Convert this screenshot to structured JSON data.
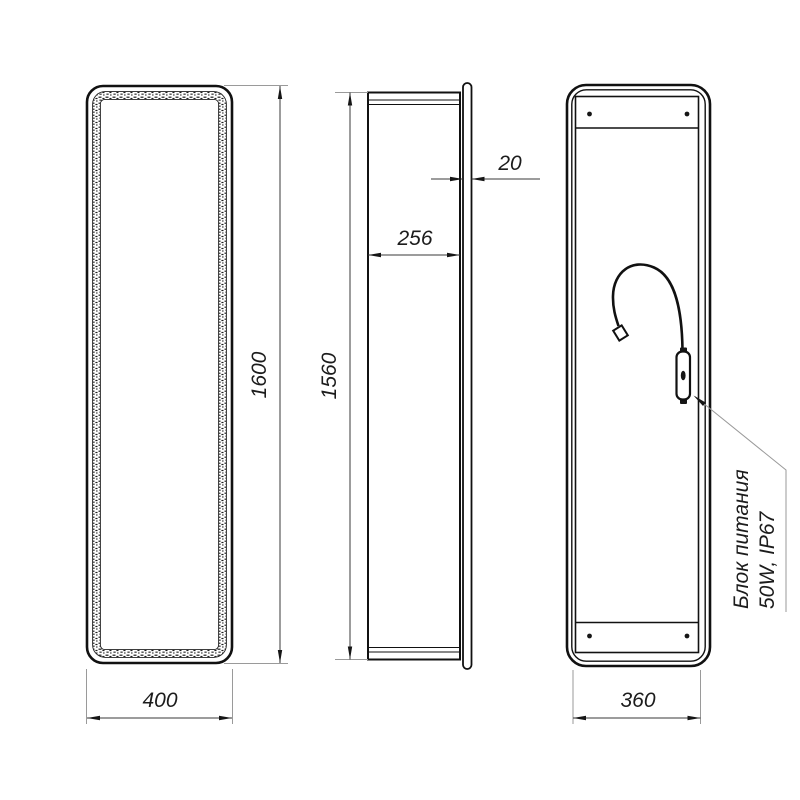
{
  "drawing": {
    "background": "#ffffff",
    "object_line_color": "#111111",
    "dimension_line_color": "#3a3a3a",
    "extension_line_color": "#9a9a9a",
    "views": {
      "front": {
        "height_dim": "1600",
        "width_dim": "400"
      },
      "side": {
        "height_dim": "1560",
        "depth_dim": "256",
        "panel_thickness_dim": "20"
      },
      "back": {
        "width_dim": "360"
      }
    },
    "callout": {
      "line1": "Блок питания",
      "line2": "50W, IP67"
    }
  }
}
